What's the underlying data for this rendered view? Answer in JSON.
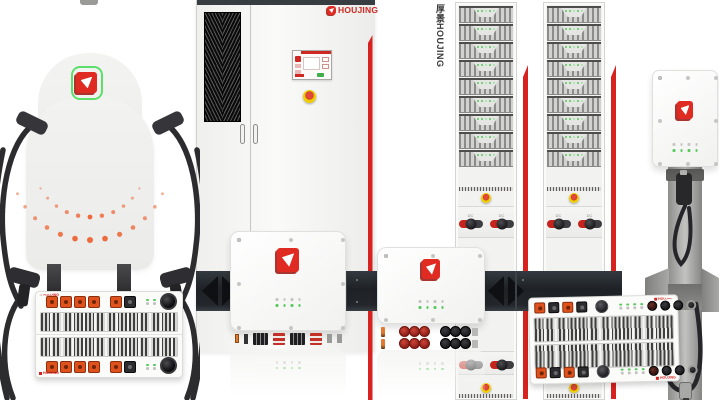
{
  "window": {
    "width": 719,
    "height": 400,
    "background": "#ffffff"
  },
  "brand": {
    "logo_text": "HOUJING",
    "rack_side_label": "厚景HOUJING",
    "logo_red": "#df2b21",
    "logo_outline_green": "#5ce06a",
    "accent_red": "#d6231f"
  },
  "palette": {
    "panel_dark": "#23272c",
    "port_orange": "#e0521d",
    "led_green": "#55c95b",
    "estop_yellow": "#f0cd02",
    "estop_red": "#d84034",
    "cable_black": "#2c2c2e",
    "pole_gray": "#a9a9a7",
    "arc_dot_orange": "#ed6a3c"
  },
  "racks": {
    "count": 2,
    "modules_per_rack": 9,
    "switch_label": "DC",
    "switches_per_rack": 2,
    "estops_per_rack": 2
  },
  "indicators": {
    "charger_led_rows": 2,
    "leds_per_row": 4
  }
}
